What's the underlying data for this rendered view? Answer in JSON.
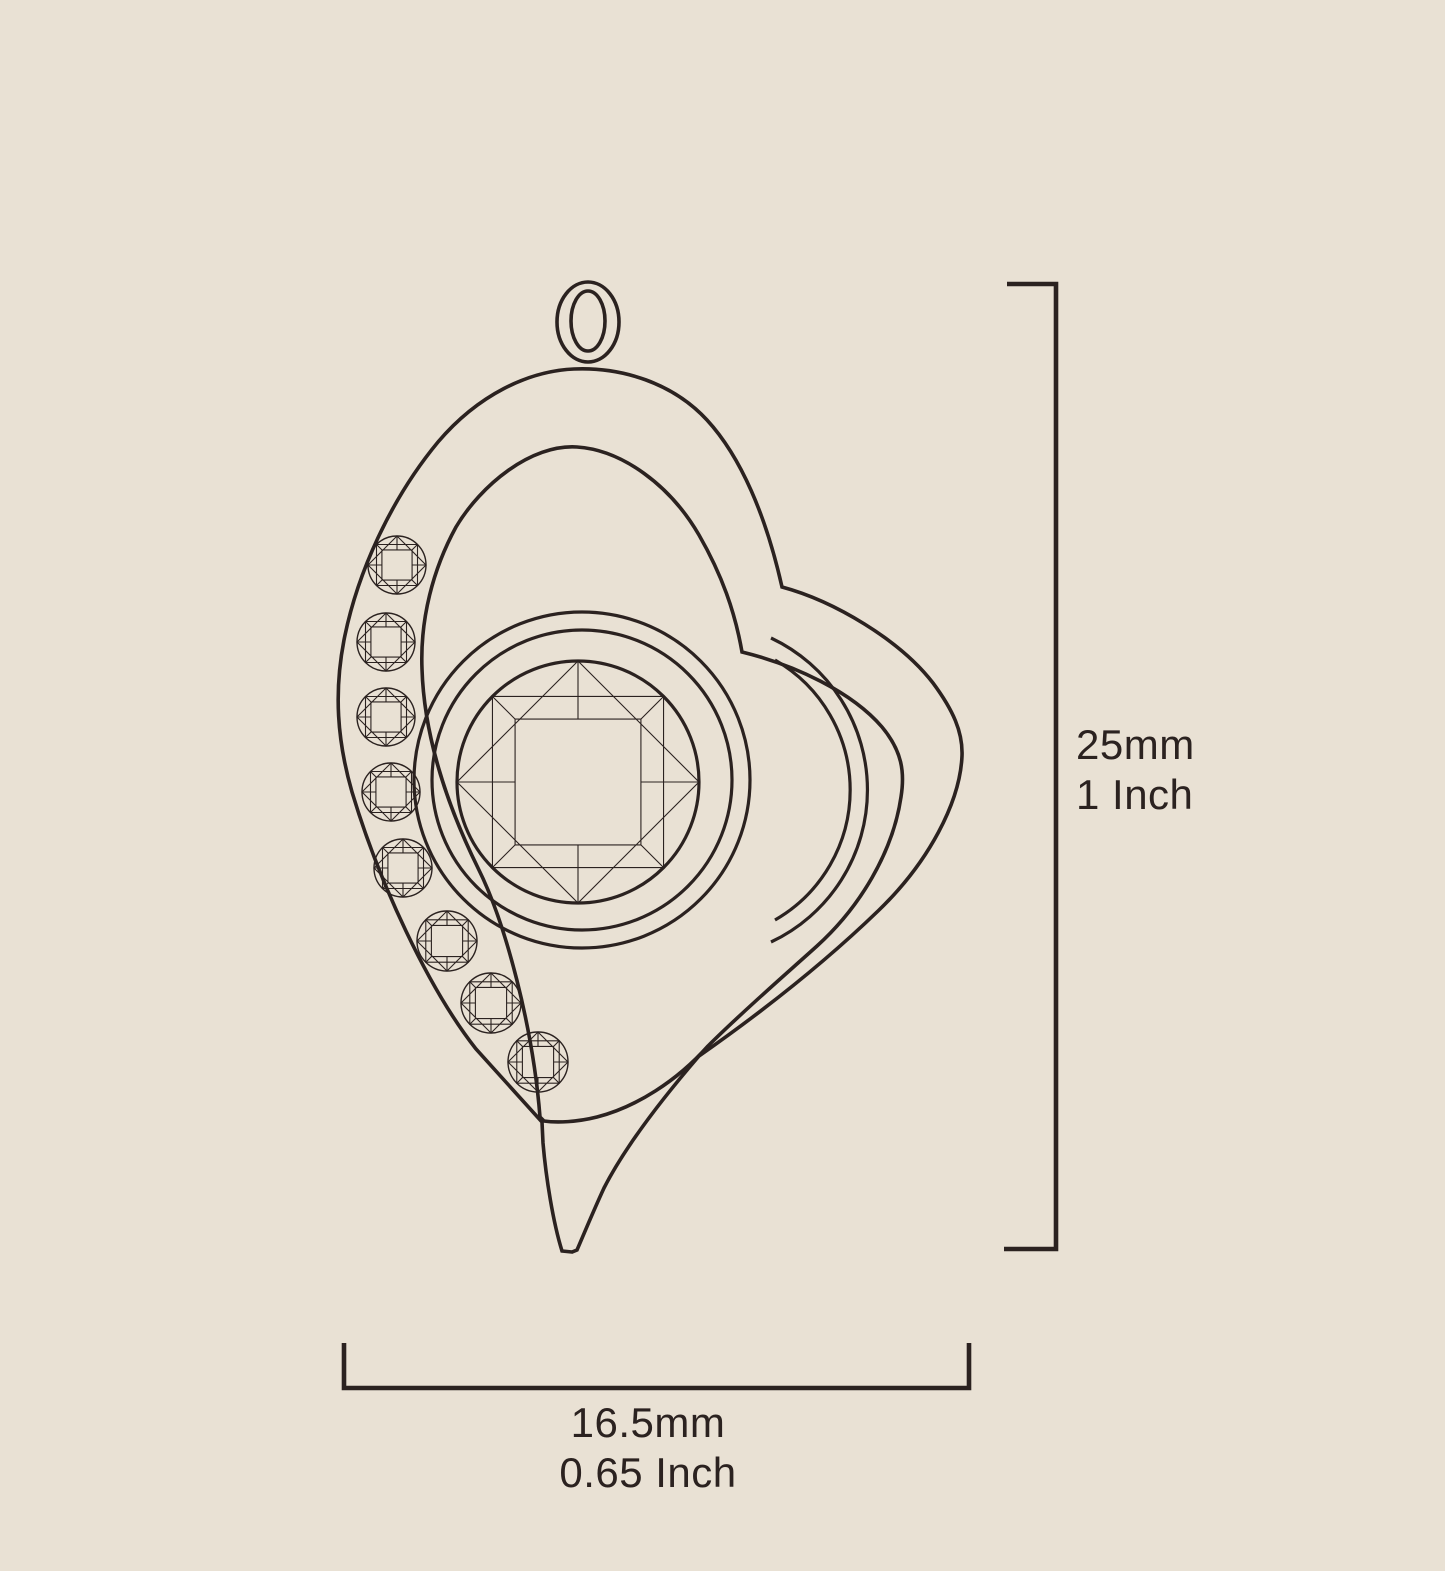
{
  "canvas": {
    "width": 1445,
    "height": 1571
  },
  "colors": {
    "background": "#e9e1d4",
    "line": "#2b2220"
  },
  "illustration": {
    "subject": "Heart-shaped pendant technical line drawing",
    "bail": "double oval bail loop",
    "center_stone": "round brilliant-cut center stone in round bezel",
    "side_stone_count": 8
  },
  "dimension_labels": {
    "height": {
      "metric": "25mm",
      "imperial": "1 Inch"
    },
    "width": {
      "metric": "16.5mm",
      "imperial": "0.65 Inch"
    }
  }
}
